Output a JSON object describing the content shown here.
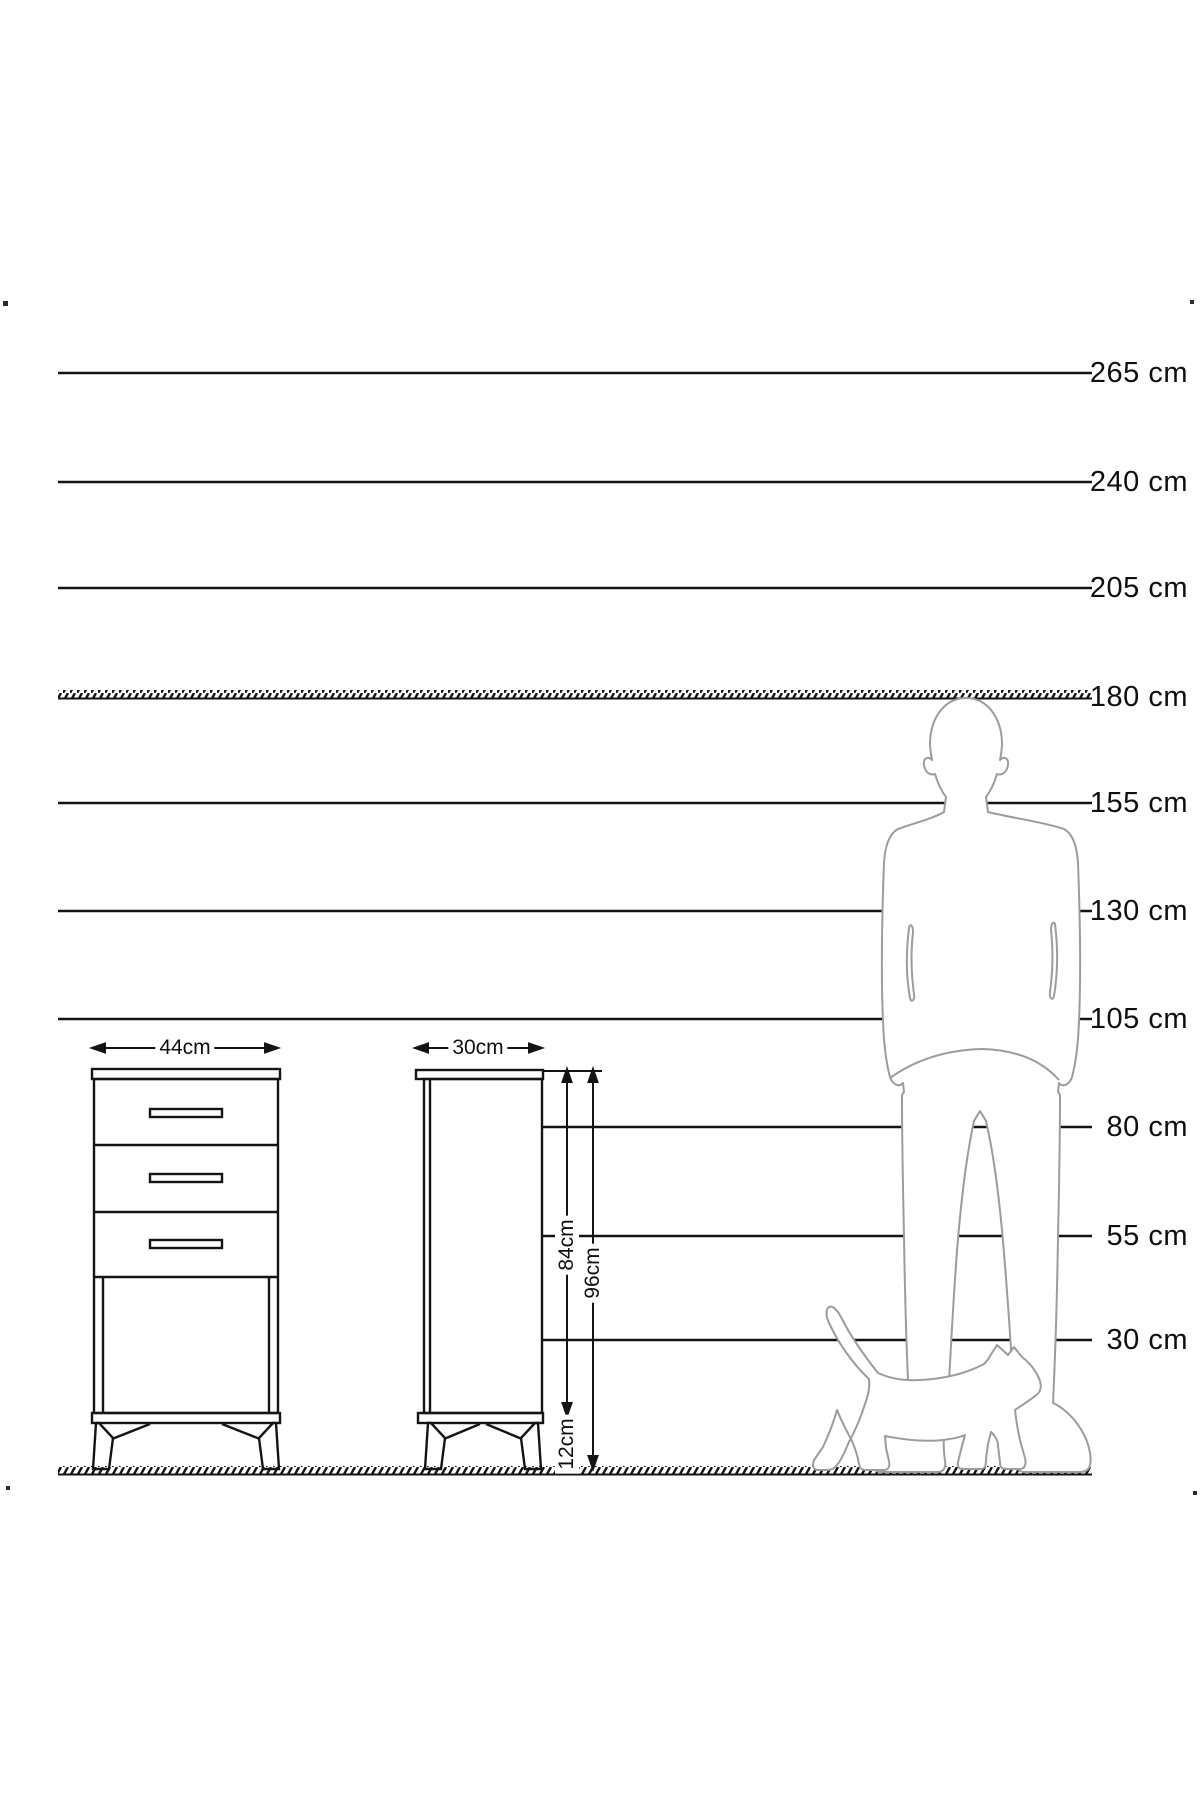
{
  "diagram": {
    "kind": "furniture-height-comparison",
    "unit": "cm",
    "background_color": "#ffffff",
    "line_color": "#141414",
    "figure_outline_color": "#9c9c9c"
  },
  "scale": {
    "labels": [
      {
        "text": "265 cm",
        "value": 265
      },
      {
        "text": "240 cm",
        "value": 240
      },
      {
        "text": "205 cm",
        "value": 205
      },
      {
        "text": "180 cm",
        "value": 180
      },
      {
        "text": "155 cm",
        "value": 155
      },
      {
        "text": "130 cm",
        "value": 130
      },
      {
        "text": "105 cm",
        "value": 105
      },
      {
        "text": "80 cm",
        "value": 80
      },
      {
        "text": "55 cm",
        "value": 55
      },
      {
        "text": "30 cm",
        "value": 30
      }
    ]
  },
  "cabinet": {
    "front_width_label": "44cm",
    "side_depth_label": "30cm",
    "body_height_label": "84cm",
    "total_height_label": "96cm",
    "leg_height_label": "12cm",
    "drawer_count": 3
  },
  "figures": {
    "man": "man-silhouette-180cm",
    "cat": "cat-silhouette"
  }
}
